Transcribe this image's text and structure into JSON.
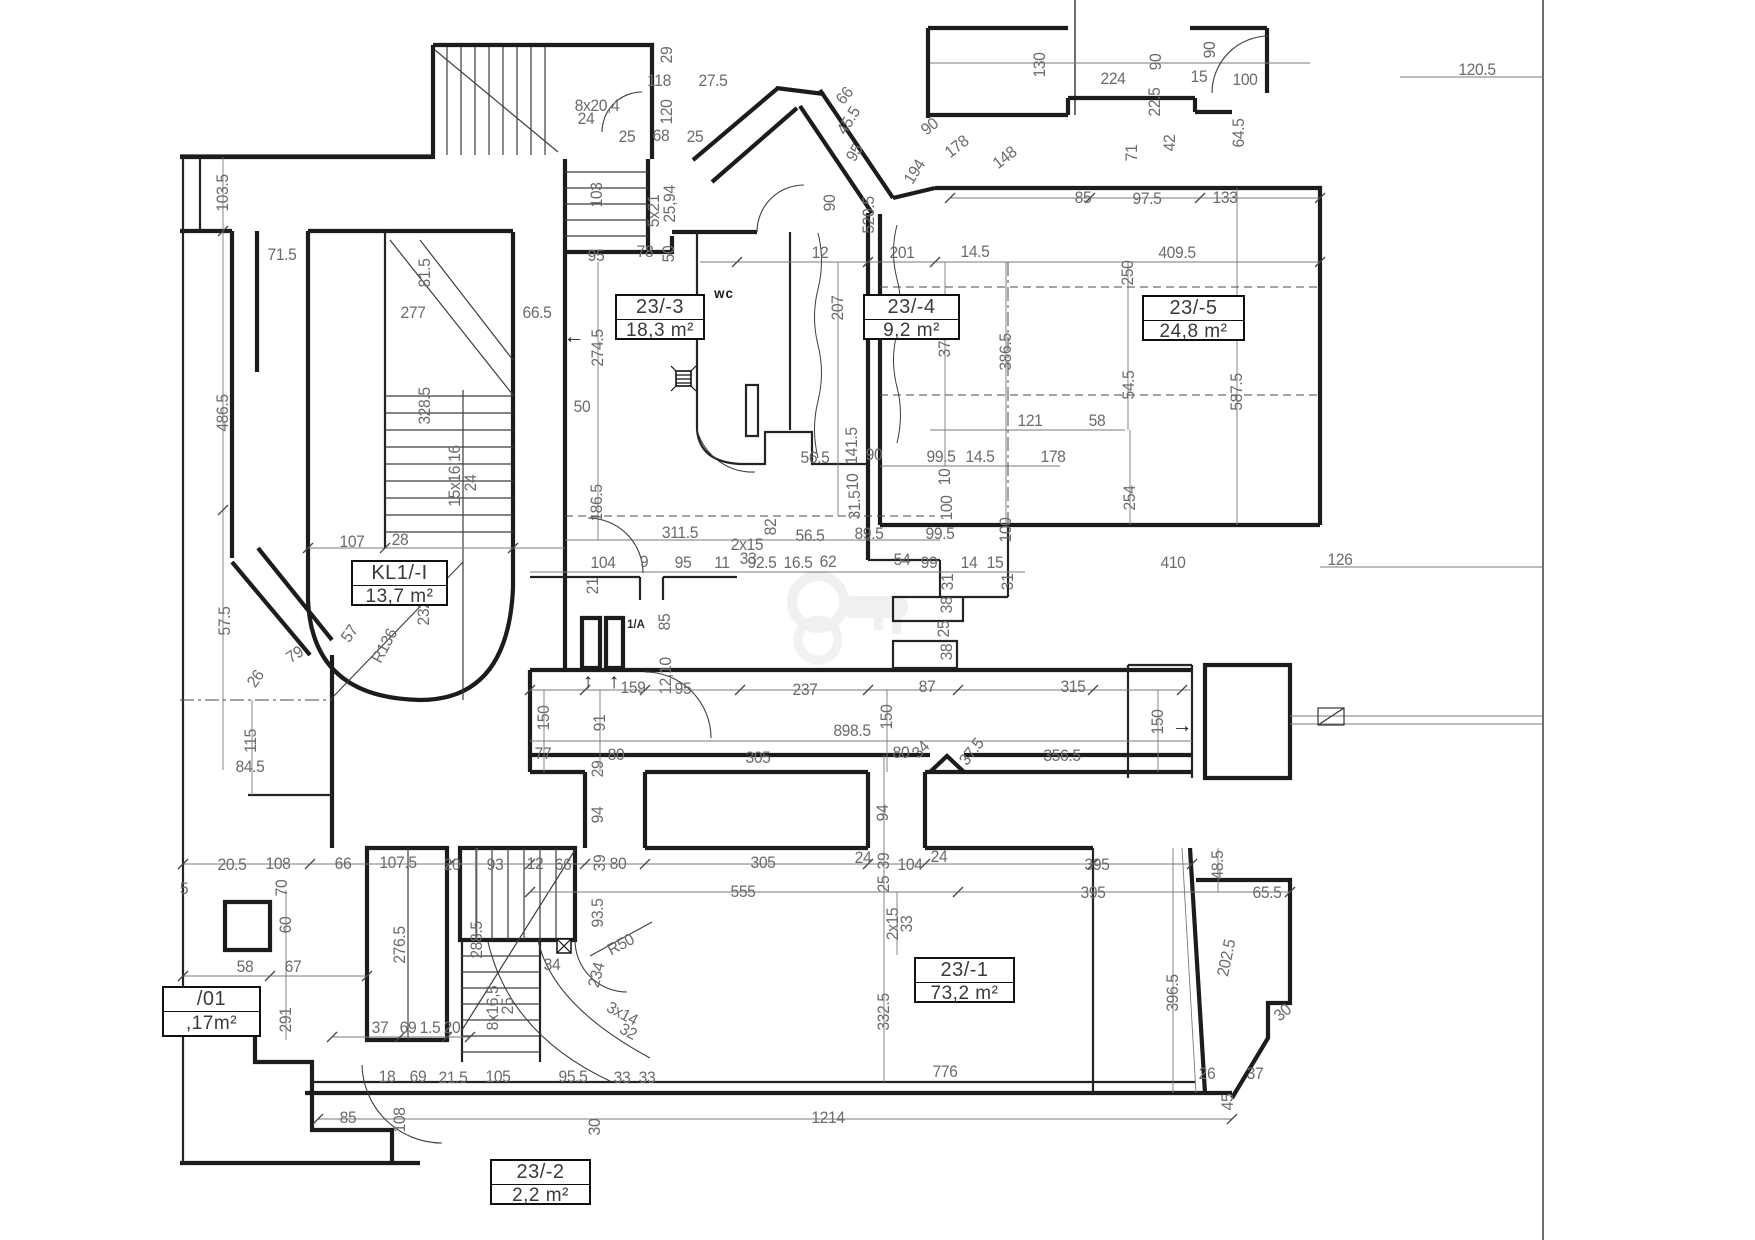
{
  "drawing": {
    "type": "architectural-floor-plan",
    "colors": {
      "wall": "#1c1c1c",
      "thin_line": "#3d3d3d",
      "dim_line": "#7a7a7a",
      "dim_text": "#6b6b6b",
      "room_text": "#3a3a3a",
      "background": "#ffffff",
      "watermark": "rgba(0,0,0,0.055)"
    }
  },
  "rooms": [
    {
      "id": "23/-3",
      "area": "18,3 m²",
      "x": 615,
      "y": 294,
      "w": 86,
      "h": 42
    },
    {
      "id": "23/-4",
      "area": "9,2 m²",
      "x": 863,
      "y": 294,
      "w": 93,
      "h": 42
    },
    {
      "id": "23/-5",
      "area": "24,8 m²",
      "x": 1142,
      "y": 295,
      "w": 99,
      "h": 42
    },
    {
      "id": "KL1/-I",
      "area": "13,7 m²",
      "x": 351,
      "y": 560,
      "w": 93,
      "h": 42
    },
    {
      "id": "23/-1",
      "area": "73,2 m²",
      "x": 914,
      "y": 957,
      "w": 97,
      "h": 42
    },
    {
      "id": "23/-2",
      "area": "2,2 m²",
      "x": 490,
      "y": 1159,
      "w": 97,
      "h": 42
    },
    {
      "id": "/01",
      "area": ",17m²",
      "x": 162,
      "y": 986,
      "w": 95,
      "h": 47
    }
  ],
  "dims": [
    [
      "103.5",
      223,
      193,
      -90
    ],
    [
      "71.5",
      282,
      255,
      0
    ],
    [
      "81.5",
      425,
      273,
      -90
    ],
    [
      "277",
      413,
      313,
      0
    ],
    [
      "486.5",
      223,
      413,
      -90
    ],
    [
      "328.5",
      425,
      406,
      -90
    ],
    [
      "15x16,16",
      455,
      476,
      -90
    ],
    [
      "24",
      471,
      483,
      -90
    ],
    [
      "107",
      352,
      542,
      0
    ],
    [
      "28",
      400,
      540,
      0
    ],
    [
      "232",
      424,
      613,
      -90
    ],
    [
      "R136",
      385,
      646,
      -62
    ],
    [
      "57",
      350,
      634,
      -55
    ],
    [
      "57.5",
      225,
      621,
      -90
    ],
    [
      "79",
      295,
      655,
      -32
    ],
    [
      "26",
      256,
      679,
      -55
    ],
    [
      "115",
      251,
      741,
      -90
    ],
    [
      "84.5",
      250,
      767,
      0
    ],
    [
      "29",
      667,
      55,
      -90
    ],
    [
      "118",
      659,
      81,
      0
    ],
    [
      "27.5",
      713,
      81,
      0
    ],
    [
      "8x20,4",
      597,
      106,
      0
    ],
    [
      "24",
      586,
      119,
      0
    ],
    [
      "120",
      667,
      112,
      -90
    ],
    [
      "25",
      627,
      137,
      0
    ],
    [
      "68",
      661,
      136,
      0
    ],
    [
      "25",
      695,
      137,
      0
    ],
    [
      "103",
      597,
      195,
      -90
    ],
    [
      "5x21",
      654,
      211,
      -90
    ],
    [
      "25,94",
      670,
      204,
      -90
    ],
    [
      "95",
      596,
      256,
      0
    ],
    [
      "78",
      645,
      252,
      0
    ],
    [
      "50",
      669,
      254,
      -90
    ],
    [
      "66",
      845,
      96,
      -50
    ],
    [
      "45.5",
      849,
      121,
      -58
    ],
    [
      "95",
      855,
      153,
      -58
    ],
    [
      "90",
      930,
      127,
      -38
    ],
    [
      "178",
      957,
      147,
      -38
    ],
    [
      "148",
      1005,
      158,
      -38
    ],
    [
      "194",
      915,
      172,
      -58
    ],
    [
      "90",
      830,
      203,
      -90
    ],
    [
      "520.5",
      869,
      215,
      -90
    ],
    [
      "130",
      1040,
      65,
      -90
    ],
    [
      "224",
      1113,
      79,
      0
    ],
    [
      "90",
      1156,
      62,
      -90
    ],
    [
      "90",
      1210,
      50,
      -90
    ],
    [
      "15",
      1199,
      77,
      0
    ],
    [
      "100",
      1245,
      80,
      0
    ],
    [
      "22.5",
      1155,
      102,
      -90
    ],
    [
      "120.5",
      1477,
      70,
      0
    ],
    [
      "64.5",
      1239,
      133,
      -90
    ],
    [
      "42",
      1170,
      143,
      -90
    ],
    [
      "71",
      1132,
      153,
      -90
    ],
    [
      "85",
      1083,
      198,
      0
    ],
    [
      "97.5",
      1147,
      199,
      0
    ],
    [
      "133",
      1225,
      198,
      0
    ],
    [
      "wc",
      724,
      293,
      0,
      "wc"
    ],
    [
      "66.5",
      537,
      313,
      0
    ],
    [
      "274.5",
      598,
      348,
      -90
    ],
    [
      "50",
      582,
      407,
      0
    ],
    [
      "12",
      820,
      253,
      0
    ],
    [
      "201",
      902,
      253,
      0
    ],
    [
      "14.5",
      975,
      252,
      0
    ],
    [
      "207",
      838,
      308,
      -90
    ],
    [
      "370",
      945,
      345,
      -90
    ],
    [
      "386.5",
      1006,
      352,
      -90
    ],
    [
      "250",
      1128,
      273,
      -90
    ],
    [
      "409.5",
      1177,
      253,
      0
    ],
    [
      "587.5",
      1237,
      392,
      -90
    ],
    [
      "54.5",
      1129,
      385,
      -90
    ],
    [
      "121",
      1030,
      421,
      0
    ],
    [
      "58",
      1097,
      421,
      0
    ],
    [
      "178",
      1053,
      457,
      0
    ],
    [
      "254",
      1130,
      498,
      -90
    ],
    [
      "410",
      1173,
      563,
      0
    ],
    [
      "126",
      1340,
      560,
      0
    ],
    [
      "99.5",
      941,
      457,
      0
    ],
    [
      "14.5",
      980,
      457,
      0
    ],
    [
      "10",
      945,
      477,
      -90
    ],
    [
      "100",
      947,
      508,
      -90
    ],
    [
      "100",
      1006,
      530,
      -90
    ],
    [
      "99.5",
      940,
      534,
      0
    ],
    [
      "99",
      929,
      563,
      0
    ],
    [
      "14",
      969,
      563,
      0
    ],
    [
      "15",
      995,
      563,
      0
    ],
    [
      "31",
      948,
      582,
      -90
    ],
    [
      "31",
      1008,
      582,
      -90
    ],
    [
      "56.5",
      815,
      458,
      0
    ],
    [
      "141.5",
      852,
      446,
      -90
    ],
    [
      "90",
      874,
      455,
      0
    ],
    [
      "10",
      853,
      482,
      -90
    ],
    [
      "31.5",
      855,
      505,
      -90
    ],
    [
      "56.5",
      810,
      536,
      0
    ],
    [
      "89.5",
      869,
      534,
      0
    ],
    [
      "2x15",
      747,
      545,
      0
    ],
    [
      "33",
      748,
      559,
      0
    ],
    [
      "92.5",
      762,
      563,
      0
    ],
    [
      "16.5",
      798,
      563,
      0
    ],
    [
      "62",
      828,
      562,
      0
    ],
    [
      "54",
      902,
      560,
      0
    ],
    [
      "82",
      771,
      527,
      -90
    ],
    [
      "186.5",
      597,
      503,
      -90
    ],
    [
      "311.5",
      680,
      533,
      0
    ],
    [
      "104",
      603,
      563,
      0
    ],
    [
      "9",
      644,
      562,
      0
    ],
    [
      "95",
      683,
      563,
      0
    ],
    [
      "11",
      722,
      563,
      0
    ],
    [
      "21",
      593,
      586,
      -90
    ],
    [
      "1/A",
      636,
      624,
      0,
      "small"
    ],
    [
      "85",
      665,
      622,
      -90
    ],
    [
      "12,10",
      666,
      676,
      -90
    ],
    [
      "159",
      633,
      688,
      0
    ],
    [
      "95",
      683,
      689,
      0
    ],
    [
      "237",
      805,
      690,
      0
    ],
    [
      "87",
      927,
      687,
      0
    ],
    [
      "315",
      1073,
      687,
      0
    ],
    [
      "38",
      947,
      605,
      -90
    ],
    [
      "25",
      944,
      629,
      -90
    ],
    [
      "38",
      947,
      652,
      -90
    ],
    [
      "898.5",
      852,
      731,
      0
    ],
    [
      "150",
      544,
      718,
      -90
    ],
    [
      "150",
      887,
      717,
      -90
    ],
    [
      "150",
      1158,
      722,
      -90
    ],
    [
      "91",
      600,
      723,
      -90
    ],
    [
      "77",
      543,
      754,
      0
    ],
    [
      "80",
      616,
      755,
      0
    ],
    [
      "29",
      598,
      769,
      -90
    ],
    [
      "305",
      758,
      758,
      0
    ],
    [
      "80",
      901,
      753,
      0
    ],
    [
      "34",
      921,
      750,
      -45
    ],
    [
      "37.5",
      972,
      752,
      -52
    ],
    [
      "356.5",
      1062,
      756,
      0
    ],
    [
      "94",
      598,
      815,
      -90
    ],
    [
      "94",
      883,
      813,
      -90
    ],
    [
      "20.5",
      232,
      865,
      0
    ],
    [
      "108",
      278,
      864,
      0
    ],
    [
      "66",
      343,
      864,
      0
    ],
    [
      "107.5",
      398,
      863,
      0
    ],
    [
      "20",
      452,
      865,
      0
    ],
    [
      "93",
      495,
      865,
      0
    ],
    [
      "12",
      535,
      864,
      0
    ],
    [
      "66",
      563,
      865,
      0
    ],
    [
      "39",
      600,
      863,
      -90
    ],
    [
      "80",
      618,
      864,
      0
    ],
    [
      "305",
      763,
      863,
      0
    ],
    [
      "24",
      863,
      858,
      0
    ],
    [
      "39",
      884,
      861,
      -90
    ],
    [
      "25",
      884,
      884,
      -90
    ],
    [
      "104",
      910,
      865,
      0
    ],
    [
      "24",
      939,
      857,
      0
    ],
    [
      "395",
      1097,
      865,
      0
    ],
    [
      "555",
      743,
      892,
      0
    ],
    [
      "395",
      1093,
      893,
      0
    ],
    [
      "48.5",
      1218,
      865,
      -90
    ],
    [
      "65.5",
      1267,
      893,
      0
    ],
    [
      "70",
      282,
      888,
      -90
    ],
    [
      "60",
      286,
      925,
      -90
    ],
    [
      "58",
      245,
      967,
      0
    ],
    [
      "67",
      293,
      967,
      0
    ],
    [
      "291",
      286,
      1020,
      -90
    ],
    [
      "276.5",
      400,
      945,
      -90
    ],
    [
      "288.5",
      477,
      940,
      -90
    ],
    [
      "8x16,5",
      493,
      1008,
      -90
    ],
    [
      "25",
      508,
      1006,
      -90
    ],
    [
      "34",
      552,
      965,
      0
    ],
    [
      "234",
      597,
      975,
      -75
    ],
    [
      "R50",
      621,
      945,
      -28
    ],
    [
      "93.5",
      598,
      913,
      -90
    ],
    [
      "3x14",
      622,
      1014,
      28
    ],
    [
      "32",
      628,
      1032,
      28
    ],
    [
      "2x15",
      893,
      924,
      -90
    ],
    [
      "33",
      907,
      924,
      -90
    ],
    [
      "332.5",
      884,
      1012,
      -90
    ],
    [
      "396.5",
      1173,
      993,
      -90
    ],
    [
      "202.5",
      1227,
      958,
      -78
    ],
    [
      "30",
      1283,
      1013,
      -40
    ],
    [
      "37",
      380,
      1028,
      0
    ],
    [
      "69",
      408,
      1028,
      0
    ],
    [
      "1.5",
      430,
      1028,
      0
    ],
    [
      "20",
      452,
      1028,
      0
    ],
    [
      "18",
      387,
      1077,
      0
    ],
    [
      "69",
      418,
      1077,
      0
    ],
    [
      "21.5",
      453,
      1078,
      0
    ],
    [
      "105",
      498,
      1077,
      0
    ],
    [
      "95.5",
      573,
      1077,
      0
    ],
    [
      "33",
      622,
      1078,
      0
    ],
    [
      "33",
      647,
      1078,
      0
    ],
    [
      "85",
      348,
      1118,
      0
    ],
    [
      "108",
      400,
      1120,
      -90
    ],
    [
      "30",
      595,
      1127,
      -90
    ],
    [
      "776",
      945,
      1072,
      0
    ],
    [
      "26",
      1207,
      1074,
      0
    ],
    [
      "37",
      1255,
      1074,
      0
    ],
    [
      "45",
      1228,
      1102,
      -90
    ],
    [
      "1214",
      828,
      1118,
      0
    ],
    [
      "5",
      184,
      889,
      0
    ]
  ],
  "symbols": [
    {
      "name": "left-arrow",
      "glyph": "←",
      "x": 574,
      "y": 337
    },
    {
      "name": "right-arrow",
      "glyph": "→",
      "x": 1182,
      "y": 726
    },
    {
      "name": "up-arrow",
      "glyph": "↑",
      "x": 588,
      "y": 682
    },
    {
      "name": "up-arrow",
      "glyph": "↑",
      "x": 614,
      "y": 682
    }
  ]
}
